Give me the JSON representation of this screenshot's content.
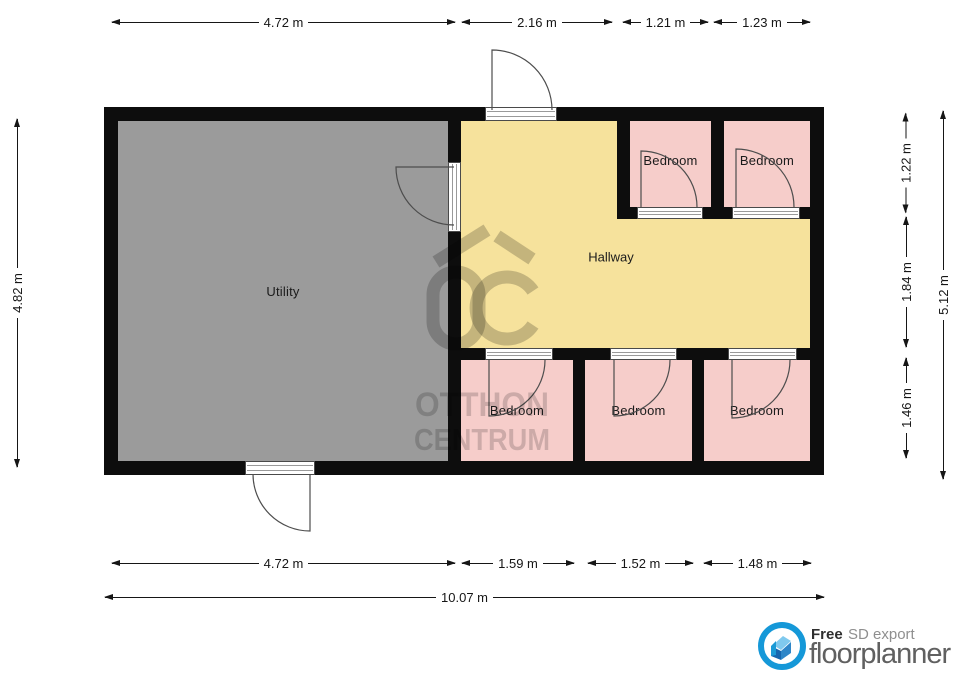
{
  "dims": {
    "top": [
      "4.72 m",
      "2.16 m",
      "1.21 m",
      "1.23 m"
    ],
    "left": "4.82 m",
    "right": [
      "1.22 m",
      "1.84 m",
      "1.46 m",
      "5.12 m"
    ],
    "bottom": [
      "4.72 m",
      "1.59 m",
      "1.52 m",
      "1.48 m",
      "10.07 m"
    ]
  },
  "rooms": [
    {
      "name": "utility",
      "label": "Utility"
    },
    {
      "name": "hallway",
      "label": "Hallway"
    },
    {
      "name": "bedroom-top-1",
      "label": "Bedroom"
    },
    {
      "name": "bedroom-top-2",
      "label": "Bedroom"
    },
    {
      "name": "bedroom-bottom-1",
      "label": "Bedroom"
    },
    {
      "name": "bedroom-bottom-2",
      "label": "Bedroom"
    },
    {
      "name": "bedroom-bottom-3",
      "label": "Bedroom"
    }
  ],
  "watermark": {
    "monogram": "OC",
    "line1": "OTTHON",
    "line2": "CENTRUM"
  },
  "footer": {
    "free": "Free",
    "export": "SD export",
    "brand": "floorplanner"
  },
  "colors": {
    "wall": "#0d0d0d",
    "utility_fill": "#9b9b9b",
    "hallway_fill": "#f6e29c",
    "bedroom_fill": "#f6cdca",
    "dimension_text": "#161616",
    "brand_blue": "#1598d8"
  }
}
